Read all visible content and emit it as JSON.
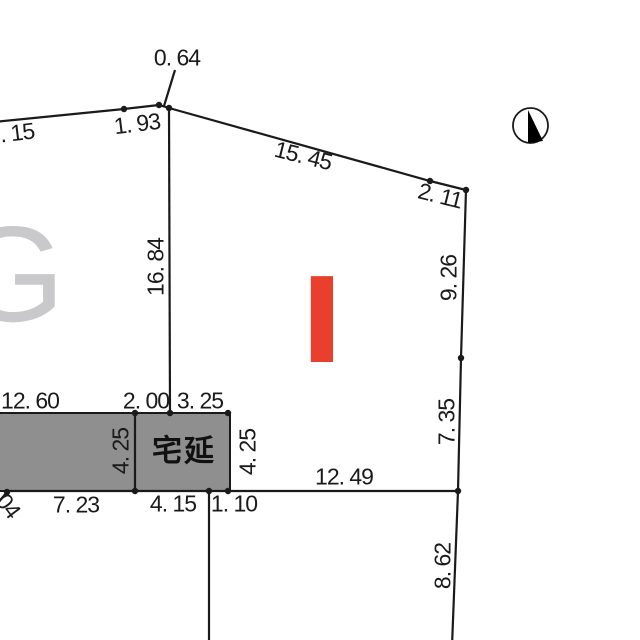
{
  "page": {
    "width": 640,
    "height": 640,
    "background": "#ffffff"
  },
  "colors": {
    "line": "#1a1a1a",
    "parcel_fill": "#8f8f8f",
    "block_letter_gray": "#c9c9cb",
    "marker_red": "#e8402c"
  },
  "block_labels": {
    "g": {
      "text": "G"
    },
    "i": {
      "text": "I"
    },
    "takuen": {
      "text": "宅延"
    }
  },
  "dimension_labels": [
    {
      "text": ". 15",
      "x": 17,
      "y": 133,
      "rot": -7
    },
    {
      "text": "1. 93",
      "x": 137,
      "y": 124,
      "rot": -7
    },
    {
      "text": "0. 64",
      "x": 177,
      "y": 58,
      "rot": 0
    },
    {
      "text": "15. 45",
      "x": 303,
      "y": 156,
      "rot": 14
    },
    {
      "text": "2. 11",
      "x": 440,
      "y": 196,
      "rot": 14
    },
    {
      "text": "16. 84",
      "x": 156,
      "y": 267,
      "rot": -90
    },
    {
      "text": "9. 26",
      "x": 449,
      "y": 278,
      "rot": -90
    },
    {
      "text": "7. 35",
      "x": 447,
      "y": 422,
      "rot": -90
    },
    {
      "text": "8. 62",
      "x": 443,
      "y": 566,
      "rot": -90
    },
    {
      "text": "12. 60",
      "x": 30,
      "y": 401,
      "rot": 0
    },
    {
      "text": "2. 00",
      "x": 146,
      "y": 401,
      "rot": 0
    },
    {
      "text": "3. 25",
      "x": 200,
      "y": 401,
      "rot": 0
    },
    {
      "text": "4. 25",
      "x": 121,
      "y": 451,
      "rot": -90
    },
    {
      "text": "4. 25",
      "x": 248,
      "y": 452,
      "rot": -90
    },
    {
      "text": "12. 49",
      "x": 344,
      "y": 477,
      "rot": 0
    },
    {
      "text": "7. 23",
      "x": 76,
      "y": 505,
      "rot": 0
    },
    {
      "text": "4. 15",
      "x": 173,
      "y": 504,
      "rot": 0
    },
    {
      "text": "1. 10",
      "x": 234,
      "y": 504,
      "rot": 0
    },
    {
      "text": "04",
      "x": 8,
      "y": 506,
      "rot": 53
    }
  ],
  "geometry": {
    "gray_parcel": [
      [
        -6,
        413
      ],
      [
        230,
        413
      ],
      [
        230,
        491
      ],
      [
        -6,
        491
      ]
    ],
    "polylines": [
      {
        "name": "upper-left-boundary",
        "points": [
          [
            -6,
            122
          ],
          [
            124,
            109
          ],
          [
            159,
            105
          ]
        ]
      },
      {
        "name": "apex-segment",
        "points": [
          [
            159,
            105
          ],
          [
            169,
            108
          ]
        ]
      },
      {
        "name": "upper-right-boundary",
        "points": [
          [
            169,
            108
          ],
          [
            430,
            181
          ],
          [
            466,
            190
          ]
        ]
      },
      {
        "name": "right-boundary",
        "points": [
          [
            466,
            190
          ],
          [
            461,
            358
          ],
          [
            458,
            491
          ]
        ]
      },
      {
        "name": "right-boundary-lower",
        "points": [
          [
            458,
            491
          ],
          [
            452,
            646
          ]
        ]
      },
      {
        "name": "center-vertical-boundary",
        "points": [
          [
            169,
            108
          ],
          [
            170,
            413
          ]
        ]
      },
      {
        "name": "bottom-baseline",
        "points": [
          [
            5,
            491
          ],
          [
            458,
            491
          ]
        ]
      },
      {
        "name": "parcel-divider",
        "points": [
          [
            135,
            413
          ],
          [
            135,
            491
          ]
        ]
      },
      {
        "name": "lower-vertical-boundary",
        "points": [
          [
            209,
            491
          ],
          [
            209,
            646
          ]
        ]
      },
      {
        "name": "southwest-diagonal",
        "points": [
          [
            7,
            492
          ],
          [
            -16,
            520
          ]
        ]
      },
      {
        "name": "leader-line-064",
        "points": [
          [
            175,
            70
          ],
          [
            164,
            106
          ]
        ]
      }
    ],
    "vertex_dots": [
      [
        124,
        109
      ],
      [
        159,
        105
      ],
      [
        169,
        108
      ],
      [
        430,
        181
      ],
      [
        466,
        190
      ],
      [
        461,
        358
      ],
      [
        458,
        491
      ],
      [
        135,
        413
      ],
      [
        170,
        413
      ],
      [
        228,
        413
      ],
      [
        7,
        492
      ],
      [
        135,
        491
      ],
      [
        209,
        491
      ],
      [
        228,
        491
      ]
    ],
    "north_arrow": {
      "cx": 530.5,
      "cy": 125.5,
      "r": 17.5,
      "needle": [
        [
          528,
          110
        ],
        [
          528,
          143
        ],
        [
          543,
          141
        ]
      ]
    }
  }
}
